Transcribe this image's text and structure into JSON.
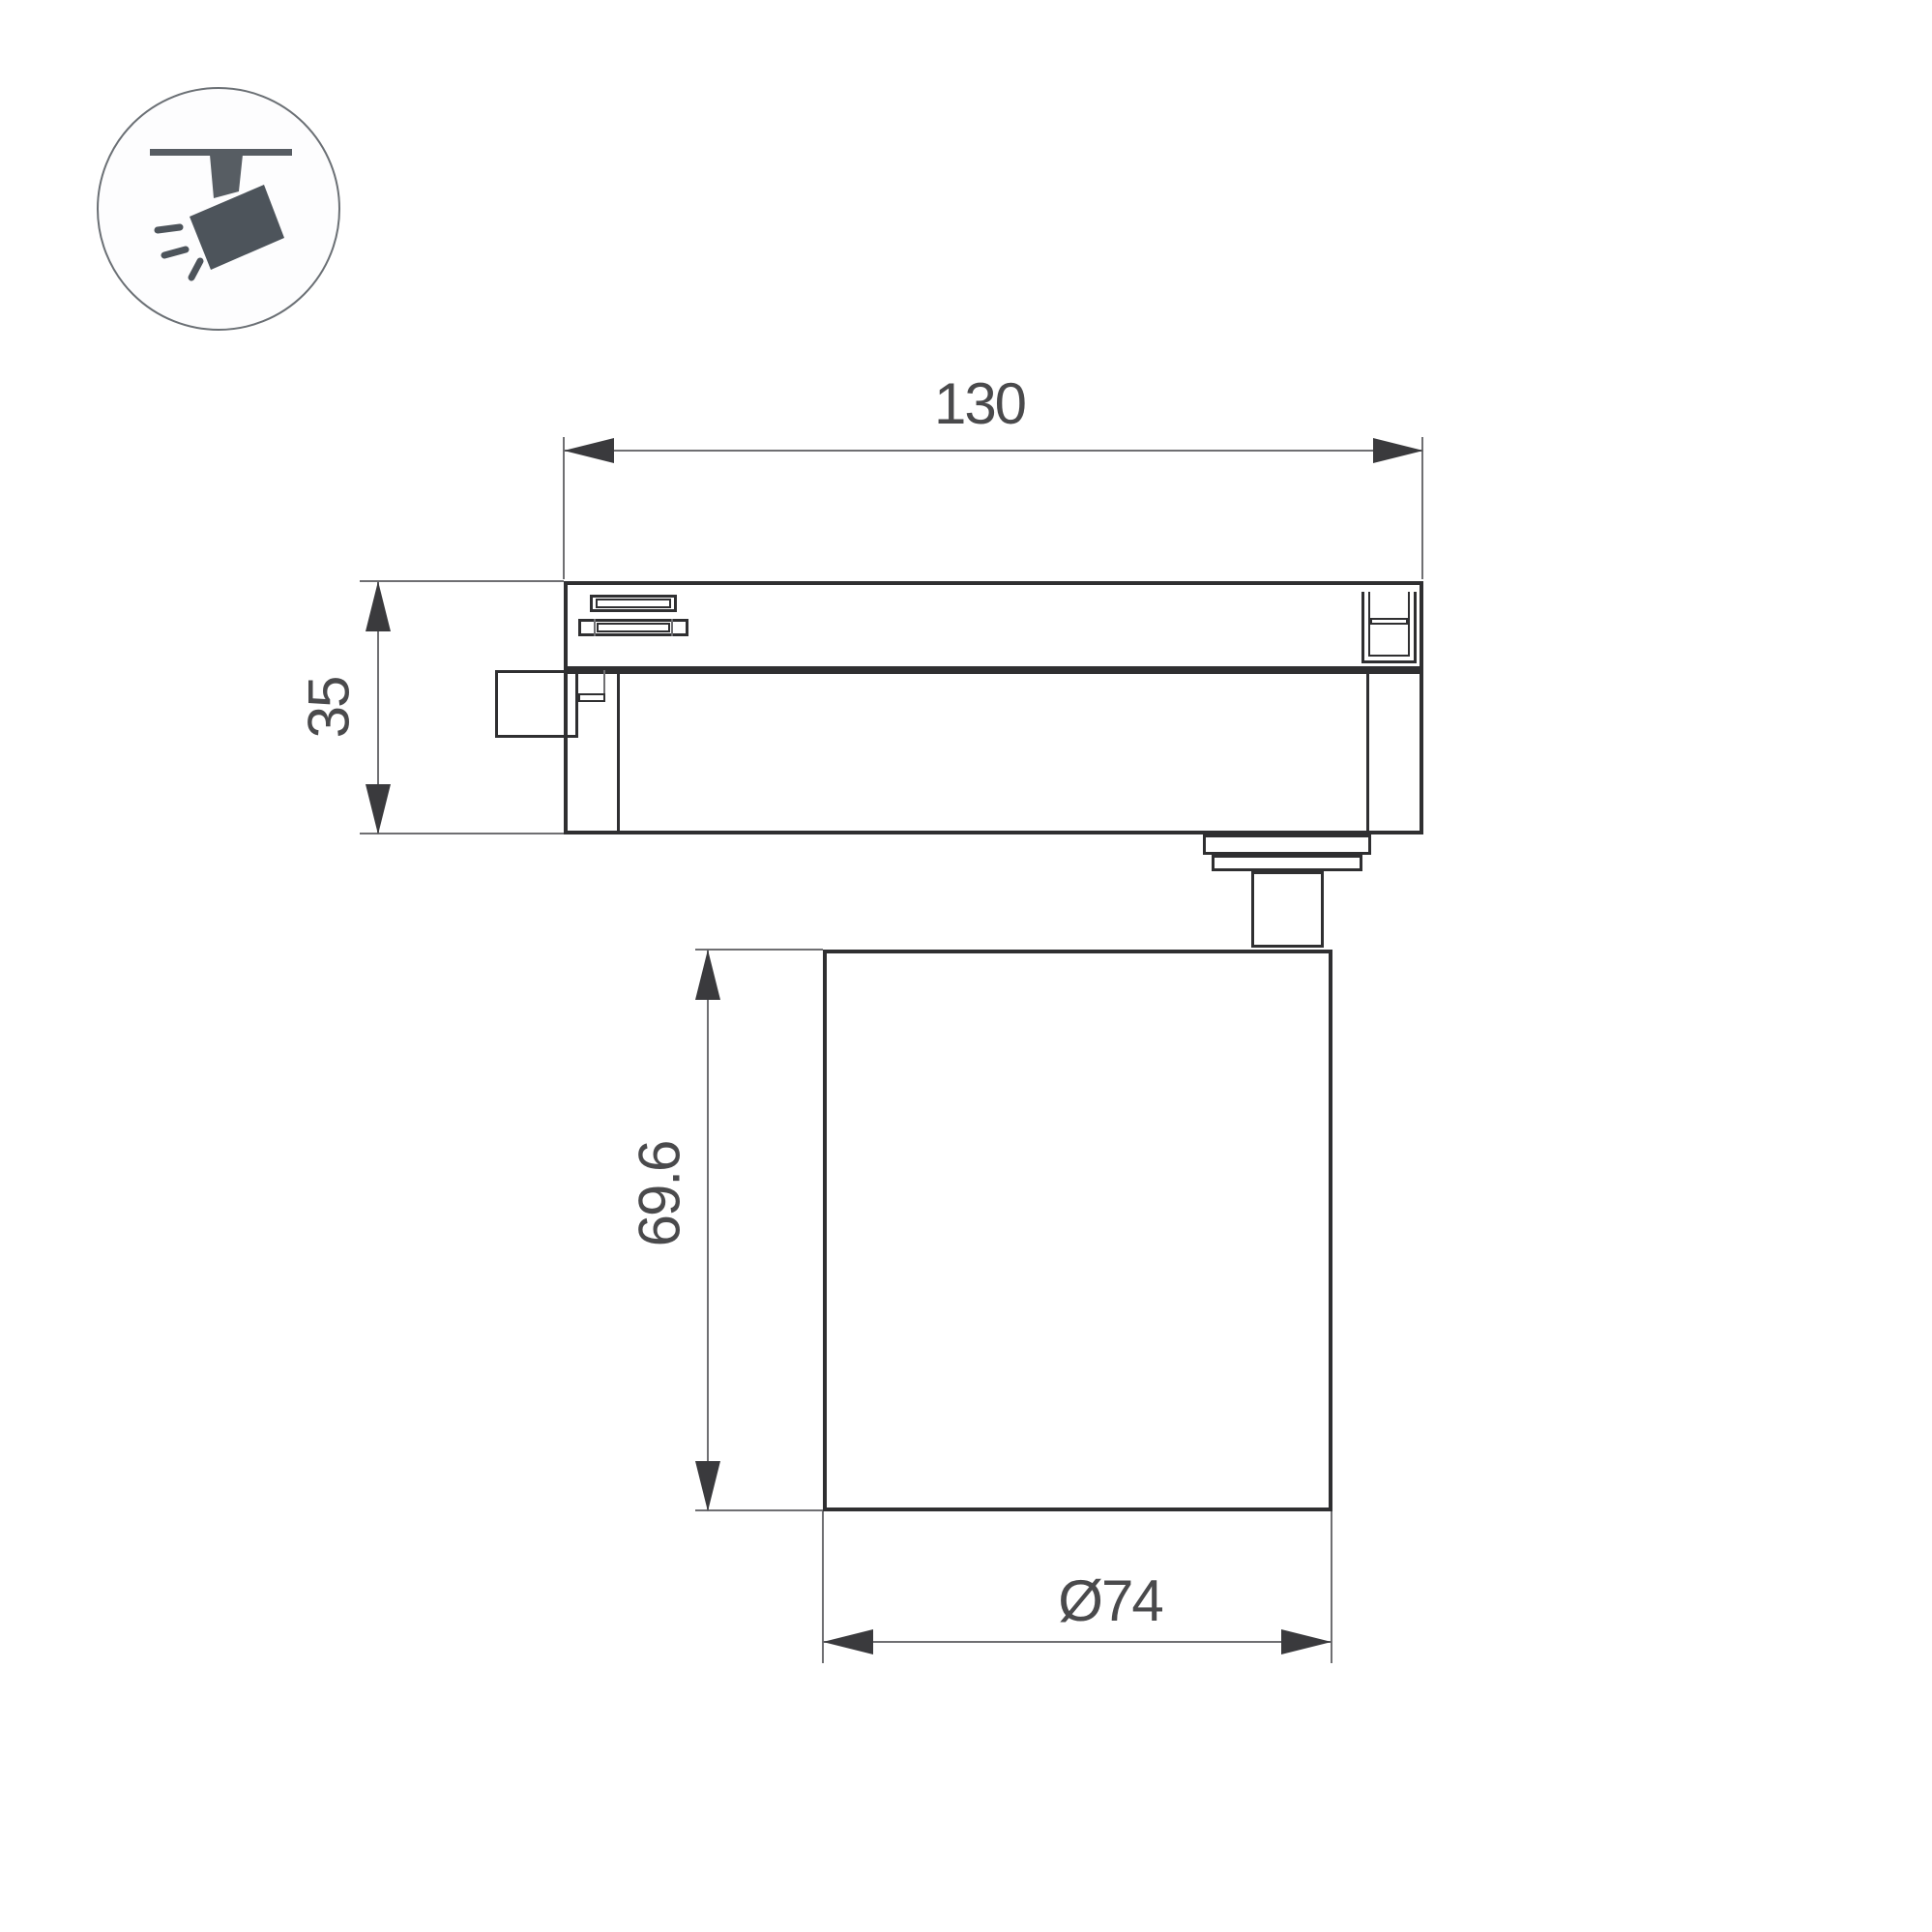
{
  "icon": {
    "name": "track-spotlight-icon"
  },
  "dimensions": {
    "track_length": {
      "label": "130"
    },
    "adapter_height": {
      "label": "35"
    },
    "head_height": {
      "label": "69.6"
    },
    "head_diameter": {
      "label": "Ø74"
    }
  },
  "colors": {
    "outline": "#2f2f31",
    "dimension_line": "#6f6f72",
    "arrow": "#3a3a3d",
    "text": "#4a4a4c",
    "icon_fill": "#4d545b",
    "background": "#ffffff"
  }
}
